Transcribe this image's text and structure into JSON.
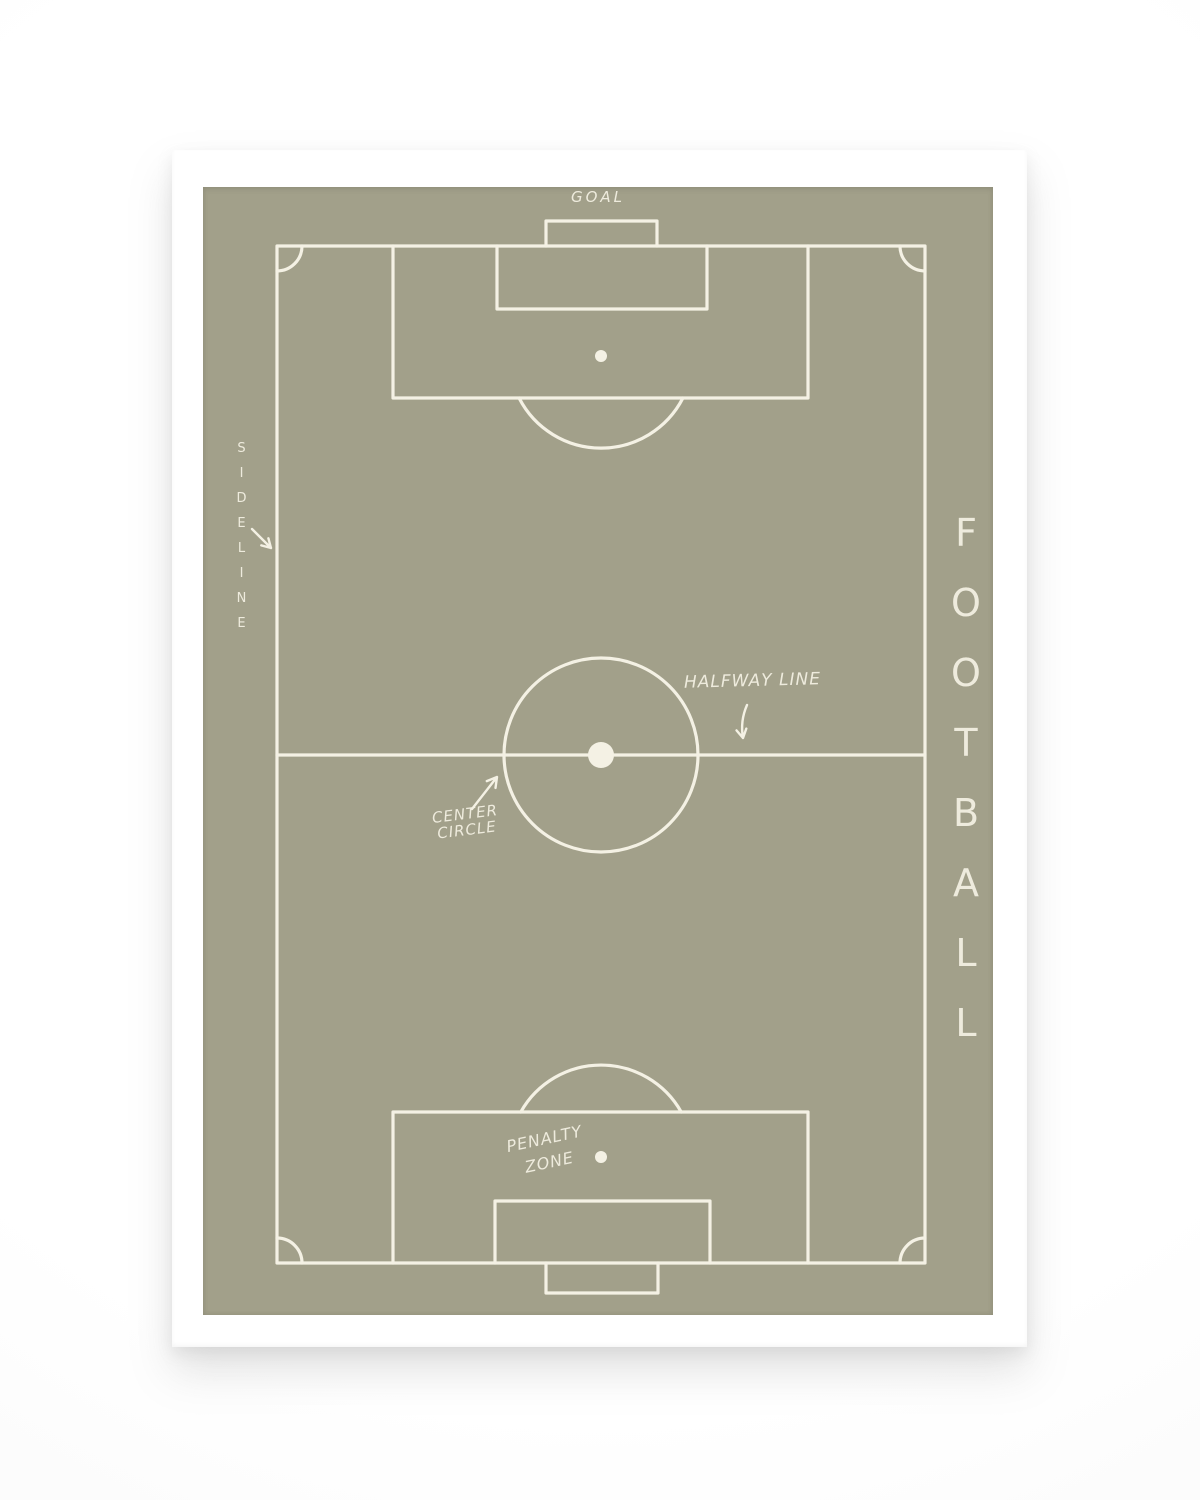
{
  "poster": {
    "labels": {
      "goal": "GOAL",
      "sideline": "SIDELINE",
      "halfway_line": "HALFWAY LINE",
      "center_circle": [
        "CENTER",
        "CIRCLE"
      ],
      "penalty_zone": [
        "PENALTY",
        "ZONE"
      ],
      "football": "FOOTBALL"
    },
    "icons": {
      "sideline_arrow": "↘",
      "halfway_line_arrow": "↓",
      "center_circle_arrow": "↗"
    },
    "colors": {
      "pitch_background": "#a2a08a",
      "pitch_lines": "#f4f1e4",
      "frame": "#ffffff",
      "page_background": "#fbfbfb"
    }
  }
}
